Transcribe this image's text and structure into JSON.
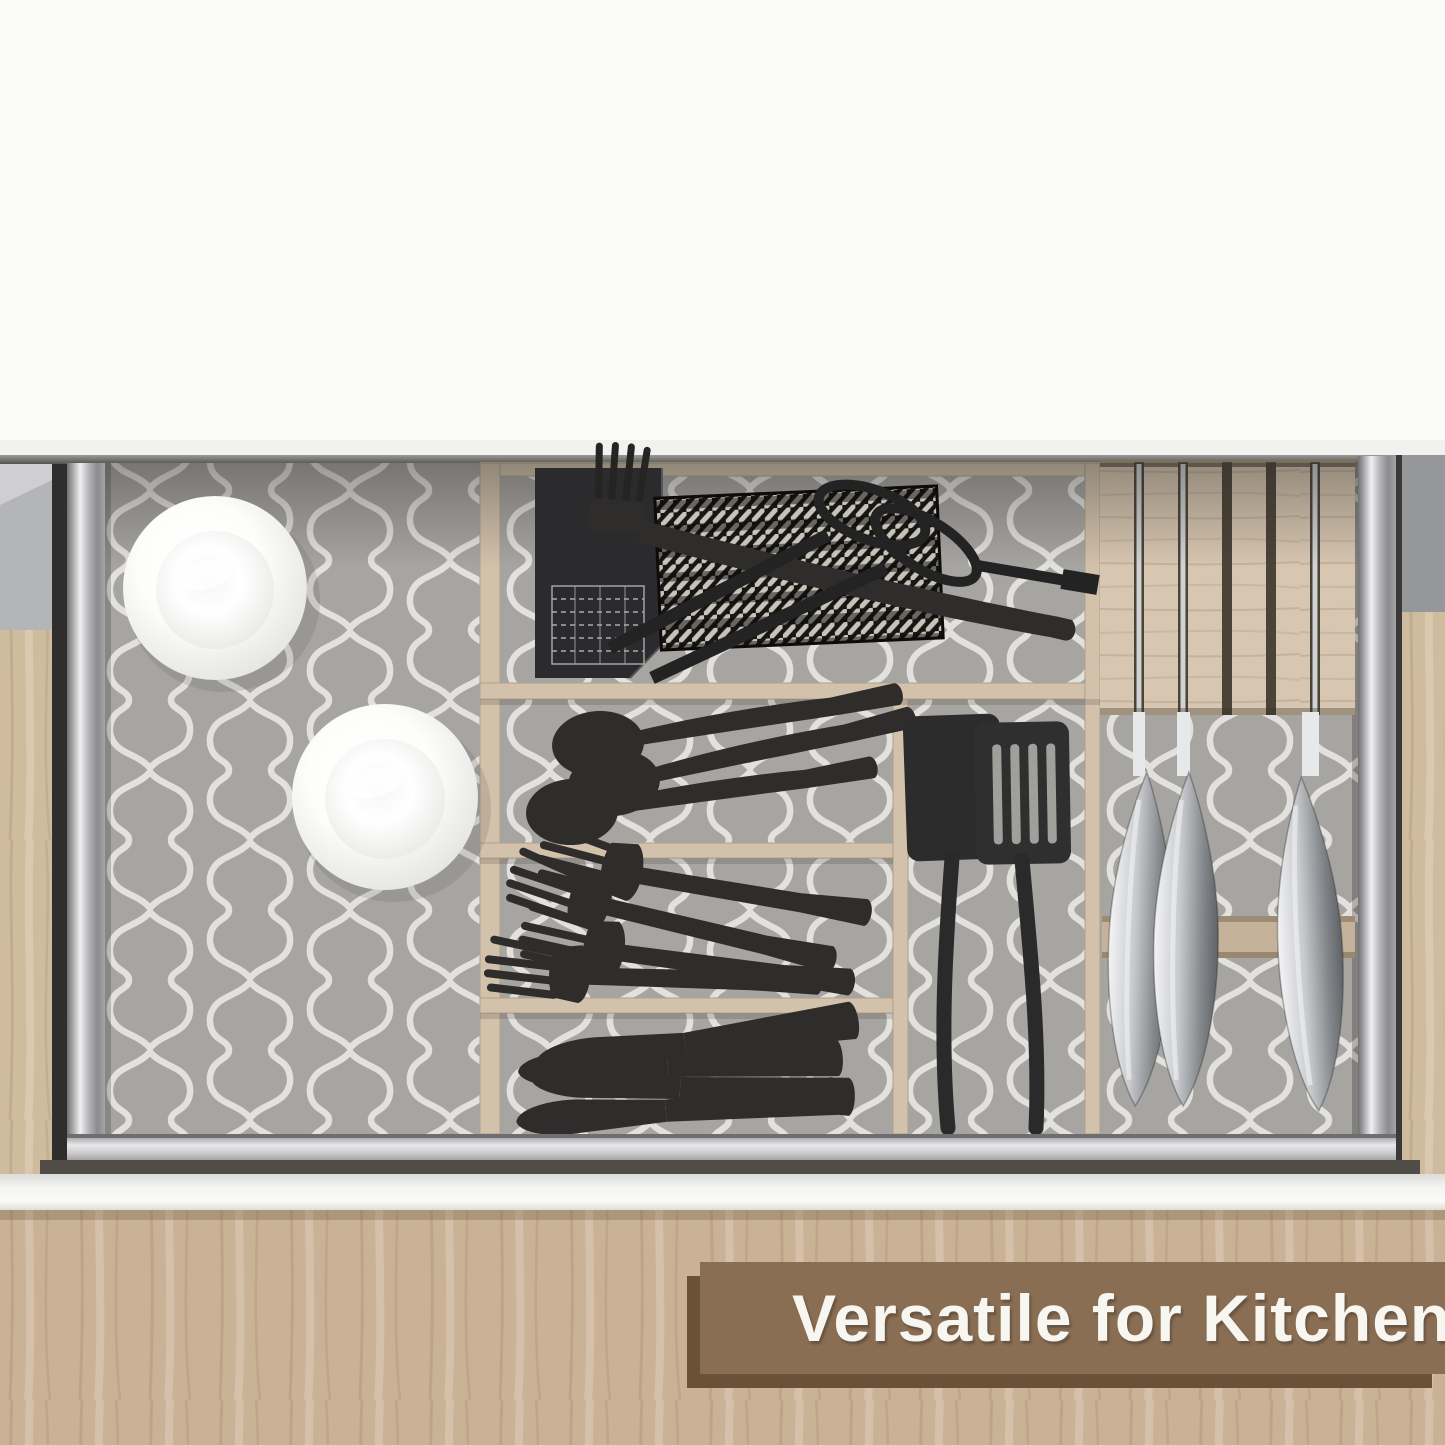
{
  "banner": {
    "text": "Versatile for Kitchen"
  },
  "scene": {
    "description": "Top view of an open kitchen drawer lined with gray quatrefoil-pattern drawer liner, with wooden organizer compartments holding black cutlery and utensils, two white bowls, grill tools on a woven mat, and a wooden knife block with steel knives.",
    "items": {
      "white_bowls": 2,
      "black_spoons": 3,
      "black_forks": 4,
      "black_table_knives": 4,
      "black_spatulas": 2,
      "grill_tools": 2,
      "steel_knives_in_block": 3,
      "black_booklet": 1
    }
  },
  "colors": {
    "banner_bg": "#8a6e54",
    "banner_shadow": "#6b5138",
    "banner_text": "#f8f6f0",
    "liner_gray": "#a7a5a2",
    "liner_line": "#e3e1dd",
    "wood_divider": "#d2c2ac",
    "wood_block": "#d7c6b1",
    "wood_side": "#cfbb9e",
    "wood_background": "#c9b296",
    "utensil_black": "#2e2d2b",
    "bowl_white": "#fcfcfb",
    "metal_bright": "#eeeef0"
  }
}
